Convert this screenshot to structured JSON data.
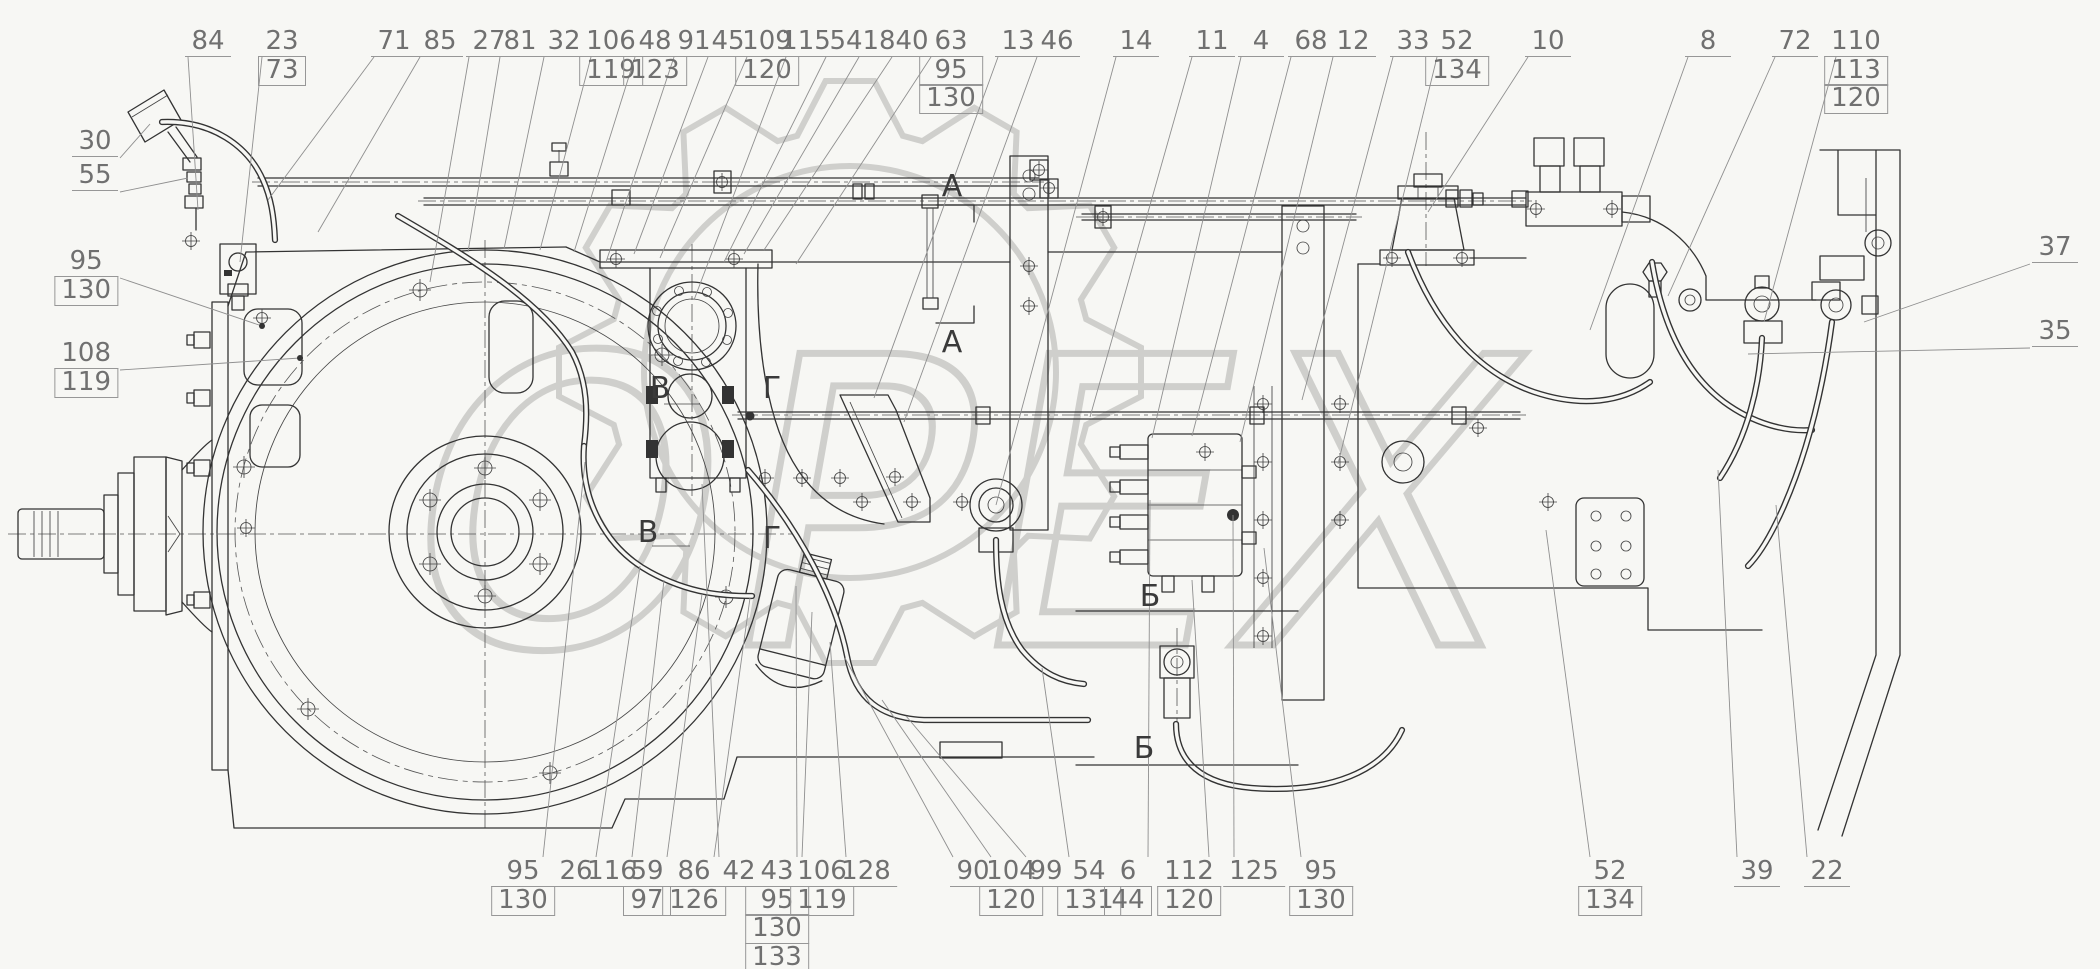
{
  "drawing": {
    "watermark_text": "OPEX",
    "background": "#f7f7f4",
    "line_color": "#333333",
    "label_color": "#707070",
    "watermark_color": "#c9c9c6"
  },
  "callouts": {
    "top": [
      {
        "x": 208,
        "lines": [
          "84"
        ],
        "t": [
          198,
          210
        ]
      },
      {
        "x": 282,
        "lines": [
          "23",
          "73"
        ],
        "t": [
          240,
          262
        ]
      },
      {
        "x": 394,
        "lines": [
          "71"
        ],
        "t": [
          268,
          200
        ]
      },
      {
        "x": 440,
        "lines": [
          "85"
        ],
        "t": [
          318,
          232
        ]
      },
      {
        "x": 489,
        "lines": [
          "27"
        ],
        "t": [
          430,
          282
        ]
      },
      {
        "x": 520,
        "lines": [
          "81"
        ],
        "t": [
          468,
          252
        ]
      },
      {
        "x": 564,
        "lines": [
          "32"
        ],
        "t": [
          504,
          249
        ]
      },
      {
        "x": 611,
        "lines": [
          "106",
          "119"
        ],
        "t": [
          540,
          250
        ]
      },
      {
        "x": 655,
        "lines": [
          "48",
          "123"
        ],
        "t": [
          574,
          252
        ]
      },
      {
        "x": 694,
        "lines": [
          "91"
        ],
        "t": [
          606,
          262
        ]
      },
      {
        "x": 728,
        "lines": [
          "45"
        ],
        "t": [
          634,
          254
        ]
      },
      {
        "x": 767,
        "lines": [
          "109",
          "120"
        ],
        "t": [
          660,
          258
        ]
      },
      {
        "x": 806,
        "lines": [
          "115"
        ],
        "t": [
          694,
          300
        ]
      },
      {
        "x": 846,
        "lines": [
          "54"
        ],
        "t": [
          724,
          262
        ]
      },
      {
        "x": 879,
        "lines": [
          "18"
        ],
        "t": [
          744,
          254
        ]
      },
      {
        "x": 912,
        "lines": [
          "40"
        ],
        "t": [
          764,
          250
        ]
      },
      {
        "x": 951,
        "lines": [
          "63",
          "95",
          "130"
        ],
        "t": [
          796,
          264
        ]
      },
      {
        "x": 1018,
        "lines": [
          "13"
        ],
        "t": [
          874,
          398
        ]
      },
      {
        "x": 1057,
        "lines": [
          "46"
        ],
        "t": [
          904,
          422
        ]
      },
      {
        "x": 1136,
        "lines": [
          "14"
        ],
        "t": [
          996,
          505
        ]
      },
      {
        "x": 1212,
        "lines": [
          "11"
        ],
        "t": [
          1090,
          417
        ]
      },
      {
        "x": 1261,
        "lines": [
          "4"
        ],
        "t": [
          1152,
          438
        ]
      },
      {
        "x": 1311,
        "lines": [
          "68"
        ],
        "t": [
          1192,
          436
        ]
      },
      {
        "x": 1353,
        "lines": [
          "12"
        ],
        "t": [
          1240,
          442
        ]
      },
      {
        "x": 1413,
        "lines": [
          "33"
        ],
        "t": [
          1302,
          400
        ]
      },
      {
        "x": 1457,
        "lines": [
          "52",
          "134"
        ],
        "t": [
          1338,
          464
        ]
      },
      {
        "x": 1548,
        "lines": [
          "10"
        ],
        "t": [
          1428,
          212
        ]
      },
      {
        "x": 1708,
        "lines": [
          "8"
        ],
        "t": [
          1590,
          330
        ]
      },
      {
        "x": 1795,
        "lines": [
          "72"
        ],
        "t": [
          1668,
          296
        ]
      },
      {
        "x": 1856,
        "lines": [
          "110",
          "113",
          "120"
        ],
        "t": [
          1764,
          322
        ]
      }
    ],
    "bottom": [
      {
        "x": 523,
        "lines": [
          "95",
          "130"
        ],
        "t": [
          585,
          462
        ]
      },
      {
        "x": 576,
        "lines": [
          "26"
        ],
        "t": [
          640,
          566
        ]
      },
      {
        "x": 612,
        "lines": [
          "116"
        ],
        "t": [
          664,
          580
        ]
      },
      {
        "x": 647,
        "lines": [
          "59",
          "97"
        ],
        "t": [
          702,
          594
        ]
      },
      {
        "x": 694,
        "lines": [
          "86",
          "126"
        ],
        "t": [
          750,
          598
        ]
      },
      {
        "x": 739,
        "lines": [
          "42"
        ],
        "t": [
          702,
          484
        ]
      },
      {
        "x": 777,
        "lines": [
          "43",
          "95",
          "130",
          "133"
        ],
        "t": [
          796,
          586
        ]
      },
      {
        "x": 822,
        "lines": [
          "106",
          "119"
        ],
        "t": [
          812,
          612
        ]
      },
      {
        "x": 866,
        "lines": [
          "128"
        ],
        "t": [
          830,
          642
        ]
      },
      {
        "x": 973,
        "lines": [
          "90"
        ],
        "t": [
          845,
          658
        ]
      },
      {
        "x": 1011,
        "lines": [
          "104",
          "120"
        ],
        "t": [
          882,
          700
        ]
      },
      {
        "x": 1046,
        "lines": [
          "99"
        ],
        "t": [
          906,
          716
        ]
      },
      {
        "x": 1089,
        "lines": [
          "54",
          "131"
        ],
        "t": [
          1042,
          668
        ]
      },
      {
        "x": 1128,
        "lines": [
          "6",
          "44"
        ],
        "t": [
          1150,
          500
        ]
      },
      {
        "x": 1189,
        "lines": [
          "112",
          "120"
        ],
        "t": [
          1192,
          580
        ]
      },
      {
        "x": 1254,
        "lines": [
          "125"
        ],
        "t": [
          1233,
          515
        ]
      },
      {
        "x": 1321,
        "lines": [
          "95",
          "130"
        ],
        "t": [
          1264,
          548
        ]
      },
      {
        "x": 1610,
        "lines": [
          "52",
          "134"
        ],
        "t": [
          1546,
          530
        ]
      },
      {
        "x": 1757,
        "lines": [
          "39"
        ],
        "t": [
          1718,
          470
        ]
      },
      {
        "x": 1827,
        "lines": [
          "22"
        ],
        "t": [
          1776,
          505
        ]
      }
    ],
    "left": [
      {
        "x": 118,
        "y": 128,
        "lines": [
          "30"
        ],
        "t": [
          150,
          124
        ]
      },
      {
        "x": 118,
        "y": 162,
        "lines": [
          "55"
        ],
        "t": [
          188,
          178
        ]
      },
      {
        "x": 118,
        "y": 248,
        "lines": [
          "95",
          "130"
        ],
        "t": [
          262,
          326
        ],
        "dot": true
      },
      {
        "x": 118,
        "y": 340,
        "lines": [
          "108",
          "119"
        ],
        "t": [
          300,
          358
        ],
        "dot": true
      }
    ],
    "right": [
      {
        "x": 2032,
        "y": 234,
        "lines": [
          "37"
        ],
        "t": [
          1864,
          322
        ]
      },
      {
        "x": 2032,
        "y": 318,
        "lines": [
          "35"
        ],
        "t": [
          1748,
          354
        ]
      }
    ]
  },
  "section_marks": [
    {
      "label": "A",
      "x": 952,
      "y": 196
    },
    {
      "label": "A",
      "x": 952,
      "y": 352
    },
    {
      "label": "B",
      "x": 660,
      "y": 398
    },
    {
      "label": "B",
      "x": 648,
      "y": 542
    },
    {
      "label": "Г",
      "x": 772,
      "y": 398
    },
    {
      "label": "Г",
      "x": 772,
      "y": 548
    },
    {
      "label": "Б",
      "x": 1150,
      "y": 606
    },
    {
      "label": "Б",
      "x": 1144,
      "y": 758
    }
  ]
}
